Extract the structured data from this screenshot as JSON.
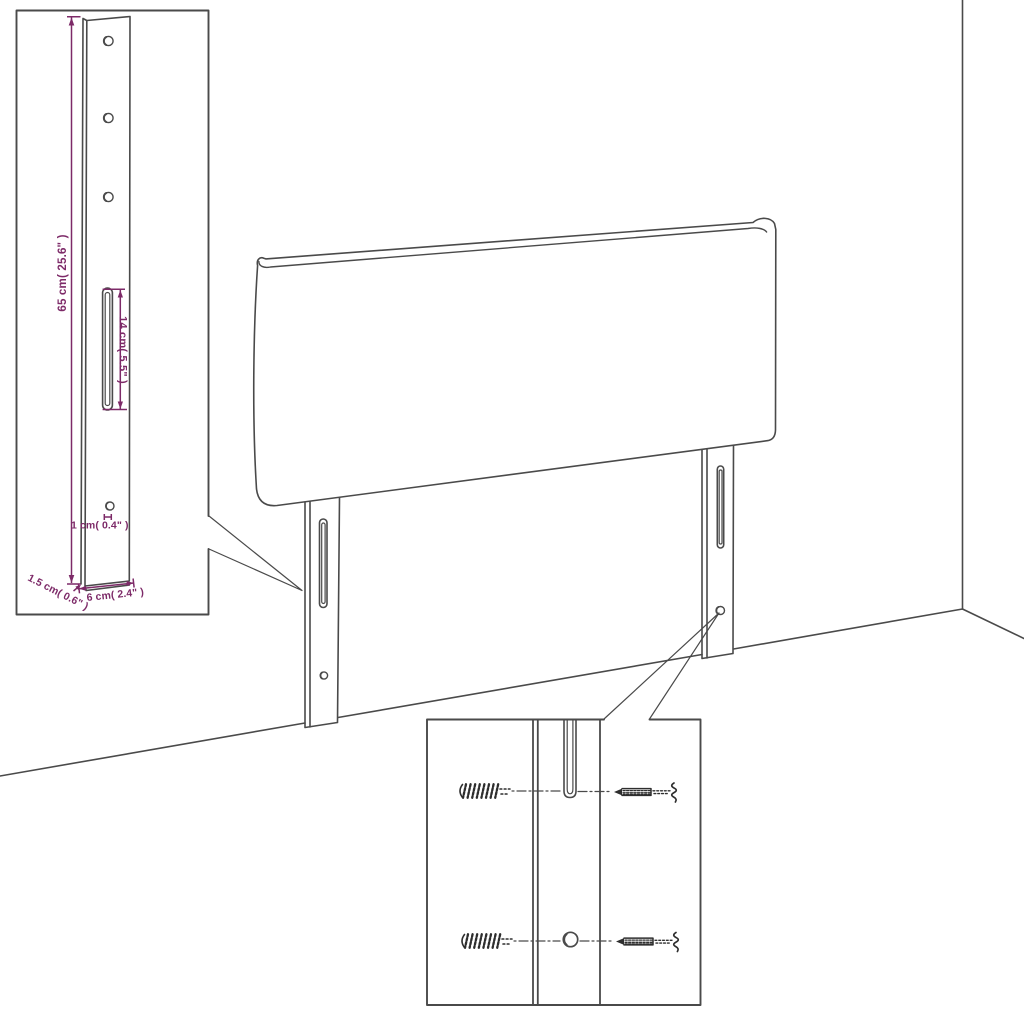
{
  "diagram": {
    "title": "headboard-assembly-dimension-diagram",
    "dimensions": {
      "leg_height_label": "65 cm( 25.6\" )",
      "slot_length_label": "14 cm( 5.5\" )",
      "hole_diameter_label": "1 cm( 0.4\"  )",
      "leg_thickness_label": "1.5 cm( 0.6\" )",
      "leg_width_label": "6 cm( 2.4\" )"
    },
    "colors": {
      "line": "#4a4a4a",
      "hardware": "#2e2e2e",
      "dimension": "#7d2a68",
      "background": "#ffffff"
    }
  }
}
